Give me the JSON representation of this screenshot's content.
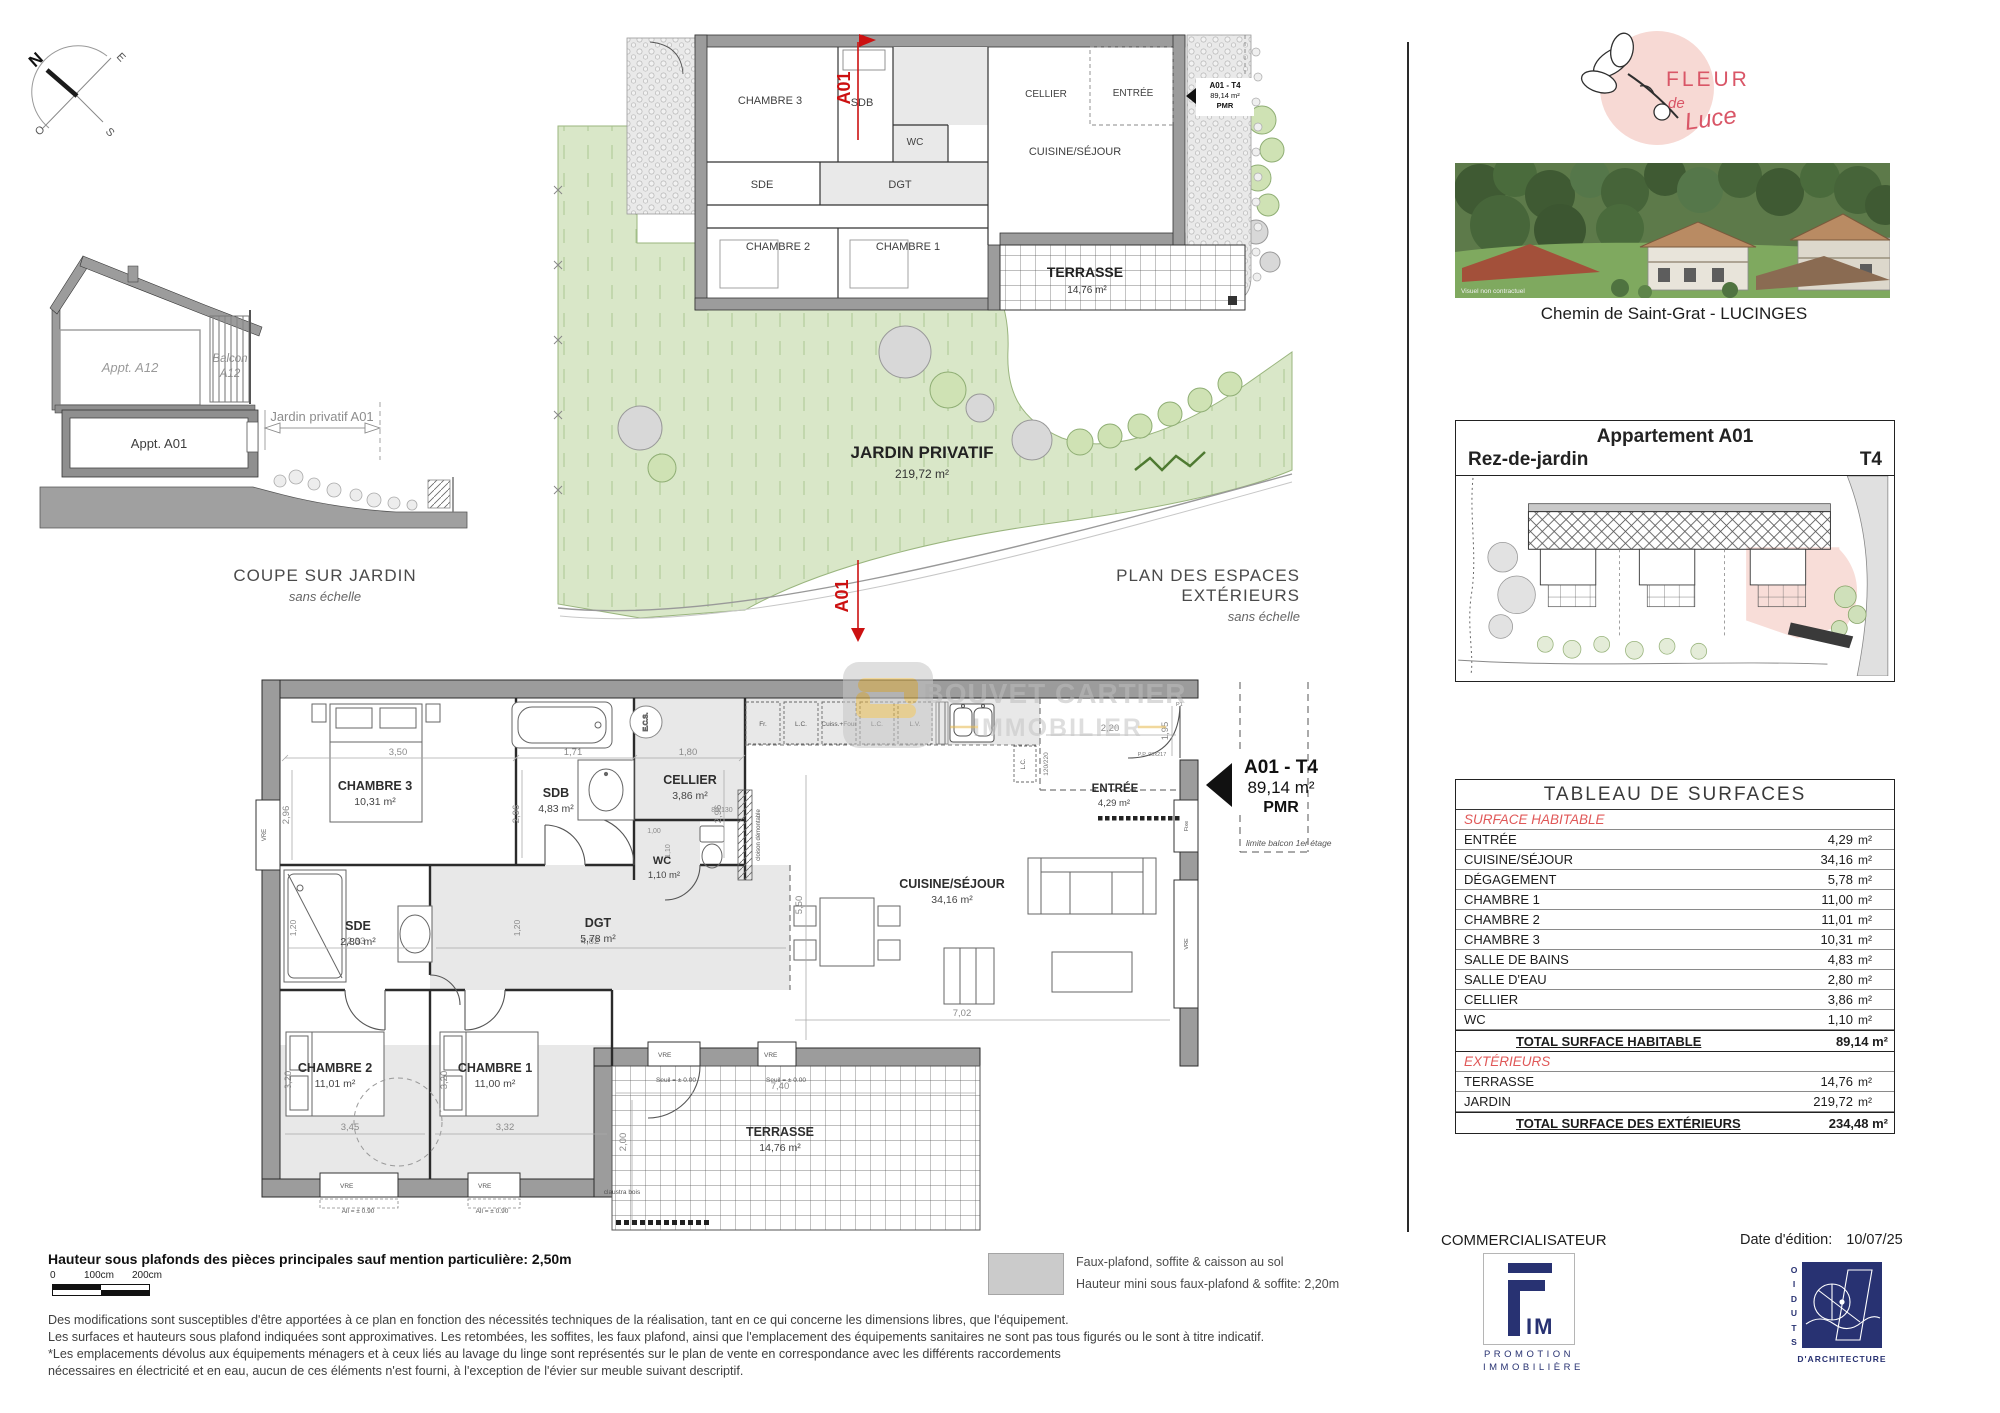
{
  "colors": {
    "accent_red": "#cc1c1c",
    "table_section_red": "#e05858",
    "brand_pink": "#f7d9d4",
    "brand_red": "#d95667",
    "navy": "#283272",
    "wall_gray": "#9c9c9c",
    "garden_green": "#d9e7c8",
    "highlight_pink": "#f8ddd8",
    "watermark_gold": "#e6b94e"
  },
  "compass": {
    "n": "N",
    "e": "E",
    "s": "S",
    "o": "O"
  },
  "coupe": {
    "title": "COUPE SUR JARDIN",
    "subtitle": "sans échelle",
    "appt_upper": "Appt. A12",
    "balcony_line1": "Balcon",
    "balcony_line2": "A12",
    "appt_lower": "Appt. A01",
    "garden_dim": "Jardin privatif A01"
  },
  "exterior_plan": {
    "title": "PLAN DES ESPACES EXTÉRIEURS",
    "subtitle": "sans échelle",
    "garden_label": "JARDIN PRIVATIF",
    "garden_area": "219,72 m²",
    "section_mark": "A01",
    "unit_tag": {
      "line1": "A01 - T4",
      "line2": "89,14 m²",
      "line3": "PMR"
    },
    "rooms": {
      "chambre3": "CHAMBRE 3",
      "sdb": "SDB",
      "cellier": "CELLIER",
      "wc": "WC",
      "sde": "SDE",
      "dgt": "DGT",
      "chambre2": "CHAMBRE 2",
      "chambre1": "CHAMBRE 1",
      "cuisine": "CUISINE/SÉJOUR",
      "entree": "ENTRÉE",
      "terrasse": "TERRASSE",
      "terrasse_area": "14,76 m²"
    }
  },
  "main_plan": {
    "watermark": {
      "line1": "BOUVET CARTIER",
      "line2": "IMMOBILIER"
    },
    "unit_tag": {
      "line1": "A01 - T4",
      "line2": "89,14 m²",
      "line3": "PMR"
    },
    "rooms": {
      "chambre3": {
        "name": "CHAMBRE 3",
        "area": "10,31 m²"
      },
      "sdb": {
        "name": "SDB",
        "area": "4,83 m²"
      },
      "cellier": {
        "name": "CELLIER",
        "area": "3,86 m²"
      },
      "wc": {
        "name": "WC",
        "area": "1,10 m²"
      },
      "sde": {
        "name": "SDE",
        "area": "2,80 m²"
      },
      "dgt": {
        "name": "DGT",
        "area": "5,78 m²"
      },
      "cuisine": {
        "name": "CUISINE/SÉJOUR",
        "area": "34,16 m²"
      },
      "entree": {
        "name": "ENTRÉE",
        "area": "4,29 m²"
      },
      "chambre2": {
        "name": "CHAMBRE 2",
        "area": "11,01 m²"
      },
      "chambre1": {
        "name": "CHAMBRE 1",
        "area": "11,00 m²"
      },
      "terrasse": {
        "name": "TERRASSE",
        "area": "14,76 m²"
      }
    },
    "kitchen": {
      "fr": "Fr.",
      "lc": "L.C.",
      "cuiss": "Cuiss.+Four",
      "lv": "L.V.",
      "ecs": "E.C.S."
    },
    "dims": {
      "w350": "3,50",
      "w171": "1,71",
      "w180": "1,80",
      "h296": "2,96",
      "w233": "2,33",
      "h120": "1,20",
      "w482": "4,82",
      "h550": "5,50",
      "w702": "7,02",
      "w345": "3,45",
      "w332": "3,32",
      "h320": "3,20",
      "w740": "7,40",
      "h200": "2,00",
      "w220": "2,20",
      "h195": "1,95",
      "w100": "1,00",
      "h110": "1,10",
      "door8013": "80/130",
      "door120220": "120/220"
    },
    "ann": {
      "p1": "P1",
      "pp": "P.P. 93x217",
      "seuil": "Seuil = ± 0.00",
      "allege": "All = ± 0.90",
      "claustra": "claustra bois",
      "cloison": "cloison démontable",
      "vre": "VRE",
      "fixe": "Fixe",
      "limite": "limite balcon 1er étage"
    }
  },
  "brand": {
    "fleur": "FLEUR",
    "de": "de",
    "luce": "Luce",
    "photo_caption": "Visuel non contractuel"
  },
  "address": "Chemin de Saint-Grat - LUCINGES",
  "unit_card": {
    "title": "Appartement A01",
    "level": "Rez-de-jardin",
    "type": "T4"
  },
  "surface_table": {
    "title": "TABLEAU DE SURFACES",
    "unit": "m²",
    "sections": [
      {
        "header": "SURFACE HABITABLE",
        "rows": [
          [
            "ENTRÉE",
            "4,29"
          ],
          [
            "CUISINE/SÉJOUR",
            "34,16"
          ],
          [
            "DÉGAGEMENT",
            "5,78"
          ],
          [
            "CHAMBRE 1",
            "11,00"
          ],
          [
            "CHAMBRE 2",
            "11,01"
          ],
          [
            "CHAMBRE 3",
            "10,31"
          ],
          [
            "SALLE DE BAINS",
            "4,83"
          ],
          [
            "SALLE D'EAU",
            "2,80"
          ],
          [
            "CELLIER",
            "3,86"
          ],
          [
            "WC",
            "1,10"
          ]
        ],
        "total": {
          "label": "TOTAL SURFACE HABITABLE",
          "value": "89,14 m²"
        }
      },
      {
        "header": "EXTÉRIEURS",
        "rows": [
          [
            "TERRASSE",
            "14,76"
          ],
          [
            "JARDIN",
            "219,72"
          ]
        ],
        "total": {
          "label": "TOTAL SURFACE DES EXTÉRIEURS",
          "value": "234,48 m²"
        }
      }
    ]
  },
  "notes": {
    "height_note": "Hauteur sous plafonds des pièces principales sauf mention particulière: 2,50m",
    "scale_ticks": [
      "0",
      "100cm",
      "200cm"
    ],
    "legend_line1": "Faux-plafond, soffite & caisson au sol",
    "legend_line2": "Hauteur mini sous faux-plafond & soffite: 2,20m",
    "disclaimer": [
      "Des modifications sont susceptibles d'être apportées à ce plan en fonction des nécessités techniques de la réalisation, tant en ce qui concerne les dimensions libres, que l'équipement.",
      "Les surfaces et hauteurs sous plafond indiquées sont approximatives. Les retombées, les soffites, les faux plafond, ainsi que l'emplacement des équipements sanitaires ne sont pas tous figurés ou le sont à titre indicatif.",
      "*Les emplacements dévolus aux équipements ménagers et à ceux liés au lavage du linge sont représentés sur le plan de vente en correspondance avec les différents raccordements",
      "nécessaires en électricité et en eau, aucun de ces éléments n'est fourni, à l'exception de l'évier sur meuble suivant descriptif."
    ]
  },
  "footer": {
    "commercialisateur": "COMMERCIALISATEUR",
    "fim_im": "IM",
    "fim_line1": "PROMOTION",
    "fim_line2": "IMMOBILIÈRE",
    "date_label": "Date d'édition:",
    "date_value": "10/07/25",
    "studio_vertical": "STUDIO",
    "studio_bottom": "D'ARCHITECTURE"
  }
}
